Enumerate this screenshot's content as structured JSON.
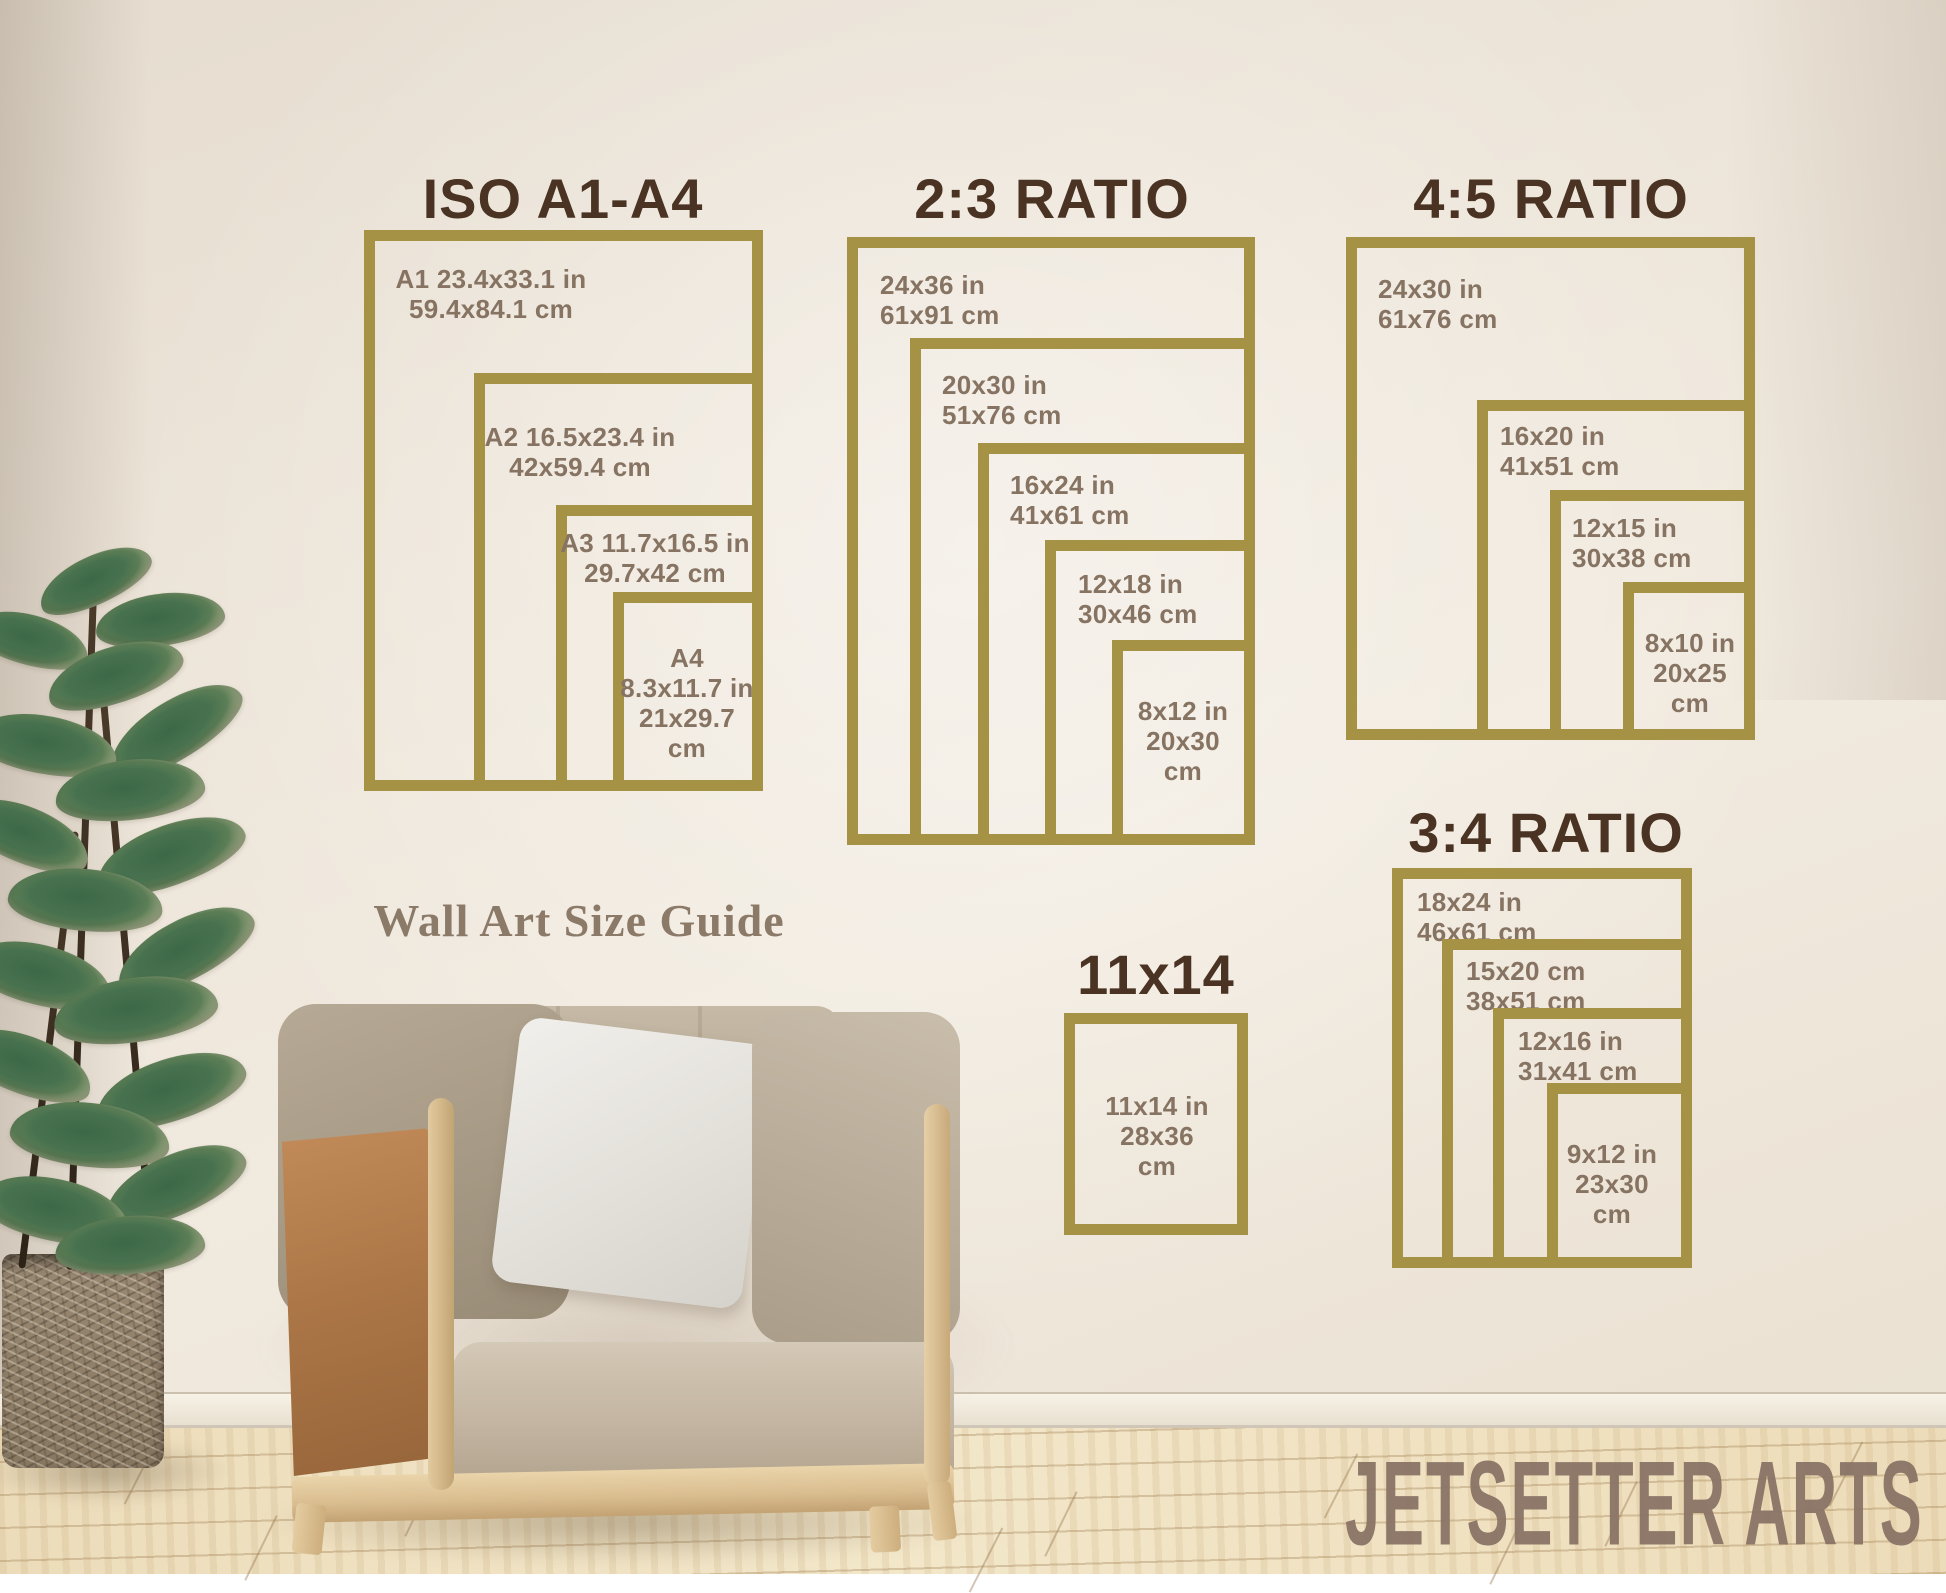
{
  "subtitle": "Wall Art Size Guide",
  "brand": "JETSETTER ARTS",
  "colors": {
    "frame_gold": "#a69245",
    "section_title": "#4a3322",
    "size_label": "#867362",
    "subtitle_text": "#8c7a69",
    "brand_text": "#8a7466"
  },
  "sections": [
    {
      "title": {
        "text": "ISO A1-A4",
        "cx": 563,
        "top": 166
      },
      "anchor_right": 763,
      "anchor_bottom": 791,
      "frames": [
        {
          "name": "A1",
          "w": 399,
          "h": 561,
          "label": {
            "lines": [
              "A1 23.4x33.1 in",
              "59.4x84.1 cm"
            ],
            "x": 491,
            "y": 264,
            "align": "center"
          }
        },
        {
          "name": "A2",
          "w": 289,
          "h": 418,
          "label": {
            "lines": [
              "A2 16.5x23.4 in",
              "42x59.4 cm"
            ],
            "x": 580,
            "y": 422,
            "align": "center"
          }
        },
        {
          "name": "A3",
          "w": 207,
          "h": 286,
          "label": {
            "lines": [
              "A3 11.7x16.5 in",
              "29.7x42 cm"
            ],
            "x": 655,
            "y": 528,
            "align": "center"
          }
        },
        {
          "name": "A4",
          "w": 150,
          "h": 199,
          "label": {
            "lines": [
              "A4",
              "8.3x11.7 in",
              "21x29.7",
              "cm"
            ],
            "x": 687,
            "y": 643,
            "align": "center"
          }
        }
      ]
    },
    {
      "title": {
        "text": "2:3 RATIO",
        "cx": 1052,
        "top": 166
      },
      "anchor_right": 1255,
      "anchor_bottom": 845,
      "frames": [
        {
          "name": "24x36",
          "w": 408,
          "h": 608,
          "label": {
            "lines": [
              "24x36 in",
              "61x91 cm"
            ],
            "x": 880,
            "y": 270,
            "align": "left"
          }
        },
        {
          "name": "20x30",
          "w": 345,
          "h": 507,
          "label": {
            "lines": [
              "20x30 in",
              "51x76 cm"
            ],
            "x": 942,
            "y": 370,
            "align": "left"
          }
        },
        {
          "name": "16x24",
          "w": 277,
          "h": 402,
          "label": {
            "lines": [
              "16x24 in",
              "41x61 cm"
            ],
            "x": 1010,
            "y": 470,
            "align": "left"
          }
        },
        {
          "name": "12x18",
          "w": 210,
          "h": 305,
          "label": {
            "lines": [
              "12x18 in",
              "30x46 cm"
            ],
            "x": 1078,
            "y": 569,
            "align": "left"
          }
        },
        {
          "name": "8x12",
          "w": 143,
          "h": 205,
          "label": {
            "lines": [
              "8x12 in",
              "20x30",
              "cm"
            ],
            "x": 1183,
            "y": 696,
            "align": "center"
          }
        }
      ]
    },
    {
      "title": {
        "text": "4:5 RATIO",
        "cx": 1551,
        "top": 166
      },
      "anchor_right": 1755,
      "anchor_bottom": 740,
      "frames": [
        {
          "name": "24x30",
          "w": 409,
          "h": 503,
          "label": {
            "lines": [
              "24x30 in",
              "61x76 cm"
            ],
            "x": 1378,
            "y": 274,
            "align": "left"
          }
        },
        {
          "name": "16x20",
          "w": 278,
          "h": 340,
          "label": {
            "lines": [
              "16x20 in",
              "41x51 cm"
            ],
            "x": 1500,
            "y": 421,
            "align": "left"
          }
        },
        {
          "name": "12x15",
          "w": 205,
          "h": 250,
          "label": {
            "lines": [
              "12x15 in",
              "30x38 cm"
            ],
            "x": 1572,
            "y": 513,
            "align": "left"
          }
        },
        {
          "name": "8x10",
          "w": 132,
          "h": 158,
          "label": {
            "lines": [
              "8x10 in",
              "20x25",
              "cm"
            ],
            "x": 1690,
            "y": 628,
            "align": "center"
          }
        }
      ]
    },
    {
      "title": {
        "text": "3:4 RATIO",
        "cx": 1546,
        "top": 800
      },
      "anchor_right": 1692,
      "anchor_bottom": 1268,
      "frames": [
        {
          "name": "18x24",
          "w": 300,
          "h": 400,
          "label": {
            "lines": [
              "18x24 in",
              "46x61 cm"
            ],
            "x": 1417,
            "y": 887,
            "align": "left"
          }
        },
        {
          "name": "15x20",
          "w": 250,
          "h": 329,
          "label": {
            "lines": [
              "15x20 cm",
              "38x51 cm"
            ],
            "x": 1466,
            "y": 956,
            "align": "left"
          }
        },
        {
          "name": "12x16",
          "w": 199,
          "h": 260,
          "label": {
            "lines": [
              "12x16 in",
              "31x41 cm"
            ],
            "x": 1518,
            "y": 1026,
            "align": "left"
          }
        },
        {
          "name": "9x12",
          "w": 145,
          "h": 185,
          "label": {
            "lines": [
              "9x12 in",
              "23x30",
              "cm"
            ],
            "x": 1612,
            "y": 1139,
            "align": "center"
          }
        }
      ]
    },
    {
      "title": {
        "text": "11x14",
        "cx": 1156,
        "top": 942
      },
      "anchor_right": 1248,
      "anchor_bottom": 1235,
      "frames": [
        {
          "name": "11x14",
          "w": 184,
          "h": 222,
          "label": {
            "lines": [
              "11x14 in",
              "28x36",
              "cm"
            ],
            "x": 1157,
            "y": 1091,
            "align": "center"
          }
        }
      ]
    }
  ]
}
